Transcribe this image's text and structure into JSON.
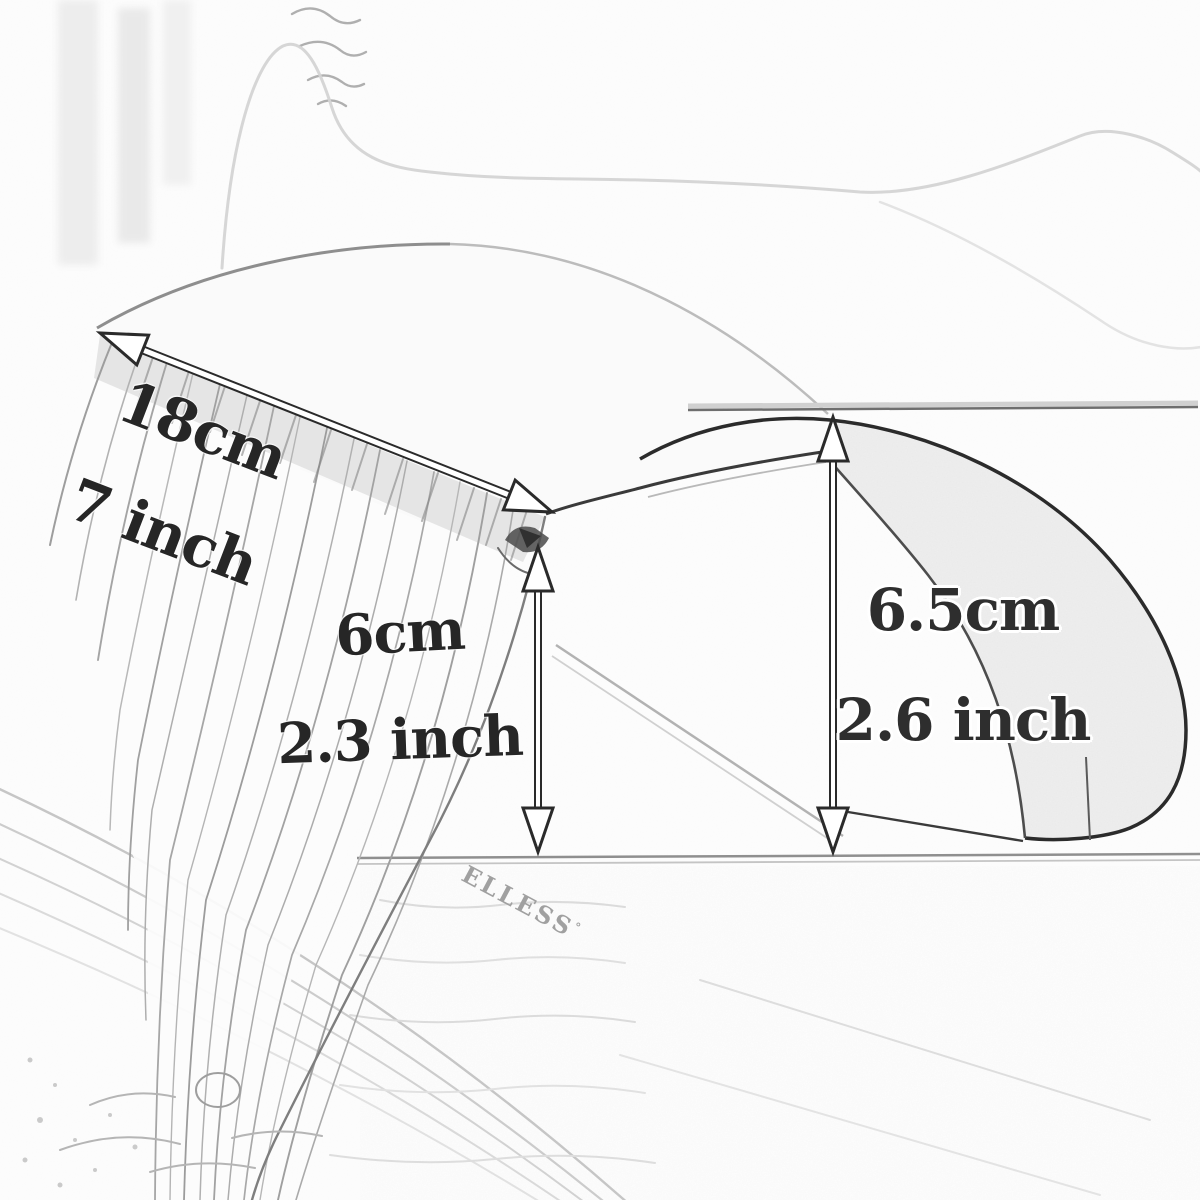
{
  "diagram": {
    "type": "product-dimension-sketch",
    "subject": "waterfall spillway faucet over pool",
    "brand": "ELLESS",
    "brand_mark": "°",
    "dimensions": [
      {
        "id": "spillway-width",
        "metric": "18cm",
        "imperial": "7 inch"
      },
      {
        "id": "lip-drop",
        "metric": "6cm",
        "imperial": "2.3 inch"
      },
      {
        "id": "arch-height",
        "metric": "6.5cm",
        "imperial": "2.6 inch"
      }
    ],
    "colors": {
      "paper": "#fdfdfd",
      "ink": "#262626",
      "line_dark": "#2b2b2b",
      "line_mid": "#8a8a8a",
      "line_faint": "#d4d4d4",
      "brand_gray": "#a0a0a0"
    }
  }
}
